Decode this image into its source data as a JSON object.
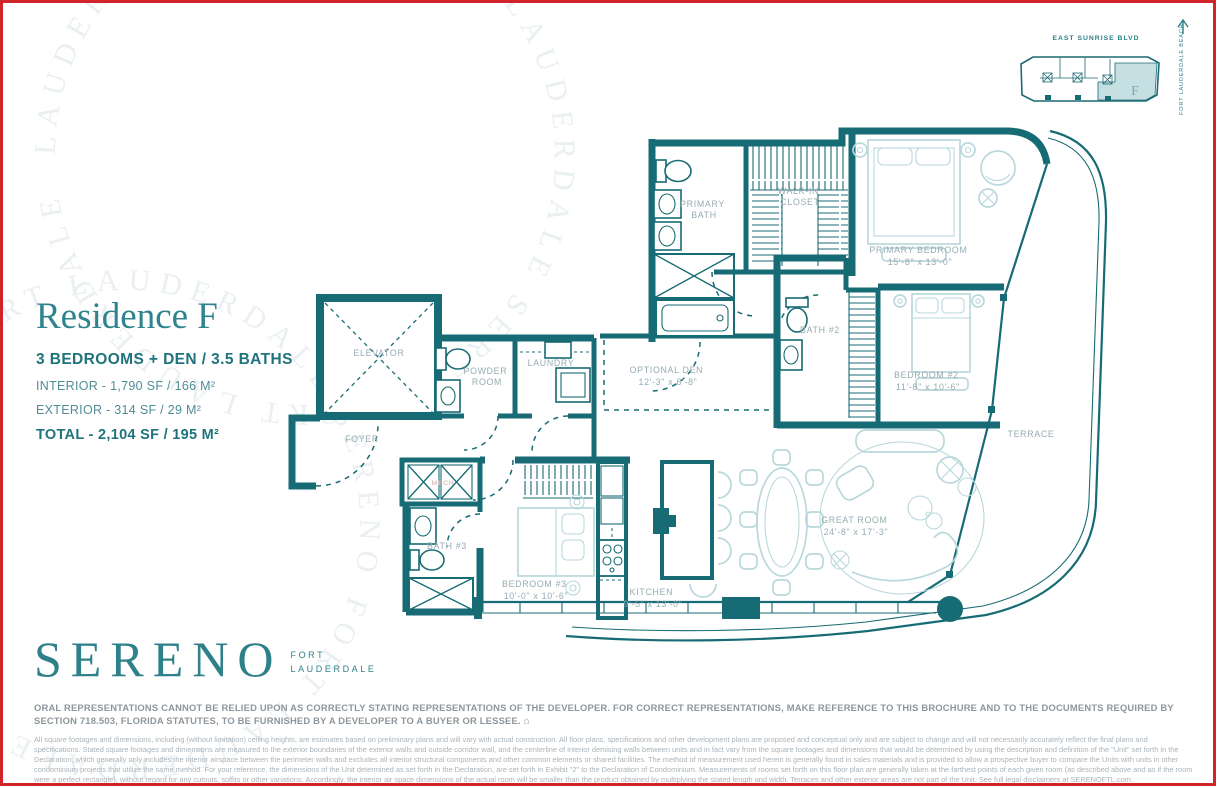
{
  "colors": {
    "wall": "#176b74",
    "furniture": "#b9d8dc",
    "room_label": "#96abb2",
    "accent": "#2e838c",
    "frame_red": "#d0232a",
    "unit_fill": "#c6dfe2"
  },
  "key_plan": {
    "street": "EAST SUNRISE BLVD",
    "beach": "FORT LAUDERDALE BEACH",
    "unit": "F"
  },
  "title_block": {
    "title": "Residence F",
    "subtitle": "3 BEDROOMS + DEN / 3.5 BATHS",
    "interior": "INTERIOR - 1,790 SF / 166 M²",
    "exterior": "EXTERIOR - 314 SF /  29 M²",
    "total": "TOTAL - 2,104 SF / 195 M²"
  },
  "logo": {
    "brand": "SERENO",
    "city_line1": "FORT",
    "city_line2": "LAUDERDALE"
  },
  "watermark": {
    "ring1": "LAUDERDALE SERENO FORT LAUDERDALE SERENO FORT LAUDERDALE",
    "ring2": "SERENO FORT LAUDERDALE SERENO FORT LAUDERDALE SERENO"
  },
  "rooms": {
    "primary_bath": [
      "PRIMARY",
      "BATH"
    ],
    "walk_in_closet": [
      "WALK-IN",
      "CLOSET"
    ],
    "primary_bedroom": [
      "PRIMARY BEDROOM",
      "15'-8\" x 13'-0\""
    ],
    "bath2": [
      "BATH #2"
    ],
    "bedroom2": [
      "BEDROOM #2",
      "11'-8\" x 10'-6\""
    ],
    "optional_den": [
      "OPTIONAL DEN",
      "12'-3\" x 6'-8\""
    ],
    "elevator": [
      "ELEVATOR"
    ],
    "powder": [
      "POWDER",
      "ROOM"
    ],
    "laundry": [
      "LAUNDRY"
    ],
    "foyer": [
      "FOYER"
    ],
    "mech": [
      "MECH"
    ],
    "bath3": [
      "BATH #3"
    ],
    "bedroom3": [
      "BEDROOM #3",
      "10'-0\" x 10'-6\""
    ],
    "kitchen": [
      "KITCHEN",
      "9'-5\" x 13'-0\""
    ],
    "great_room": [
      "GREAT ROOM",
      "24'-8\" x 17'-3\""
    ],
    "terrace": [
      "TERRACE"
    ]
  },
  "disclaimer": {
    "bold": "ORAL REPRESENTATIONS CANNOT BE RELIED UPON AS CORRECTLY STATING REPRESENTATIONS OF THE DEVELOPER. FOR CORRECT REPRESENTATIONS, MAKE REFERENCE TO THIS BROCHURE AND TO THE DOCUMENTS REQUIRED BY SECTION 718.503, FLORIDA STATUTES, TO BE FURNISHED BY A DEVELOPER TO A BUYER OR LESSEE.",
    "fine": "All square footages and dimensions, including (without limitation) ceiling heights, are estimates based on preliminary plans and will vary with actual construction. All floor plans, specifications and other development plans are proposed and conceptual only and are subject to change and will not necessarily accurately reflect the final plans and specifications. Stated square footages and dimensions are measured to the exterior boundaries of the exterior walls and outside corridor wall, and the centerline of interior demising walls between units and in fact vary from the square footages and dimensions that would be determined by using the description and definition of the \"Unit\" set forth in the Declaration, which generally only includes the interior airspace between the perimeter walls and excludes all interior structural components and other common elements or shared facilities.  The method of measurement used herein is generally found in sales materials and is provided to allow a prospective buyer to compare the Units with units in other condominium projects that utilize the same method. For your reference, the dimensions of the Unit determined as set forth in the Declaration, are set forth in Exhibit \"2\" to the Declaration of Condominium. Measurements of rooms set forth on this floor plan are generally taken at the farthest points of each given room (as described above and as if the room were a perfect rectangle), without regard for any cutouts, soffits or other variations.  Accordingly, the interior air space dimensions of the actual room will be smaller than the product obtained by multiplying the stated length and width. Terraces and other exterior areas are not part of the Unit. See full legal disclaimers at SERENOFTL.com."
  }
}
